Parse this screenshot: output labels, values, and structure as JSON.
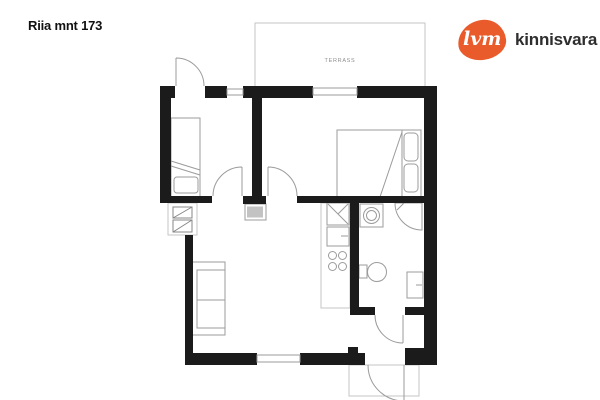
{
  "header": {
    "title": "Riia mnt 173"
  },
  "logo": {
    "mark": "lvm",
    "name": "kinnisvara",
    "brand_color": "#e95b2b",
    "text_color": "#2e2e2e"
  },
  "floorplan": {
    "terrace_label": "TERRASS",
    "wall_color": "#1b1b1b",
    "furniture_line_color": "#9b9b9b",
    "rooms": [
      "terrace",
      "bedroom-1",
      "bedroom-2",
      "living-room",
      "kitchen",
      "bathroom",
      "entry-hall"
    ]
  }
}
